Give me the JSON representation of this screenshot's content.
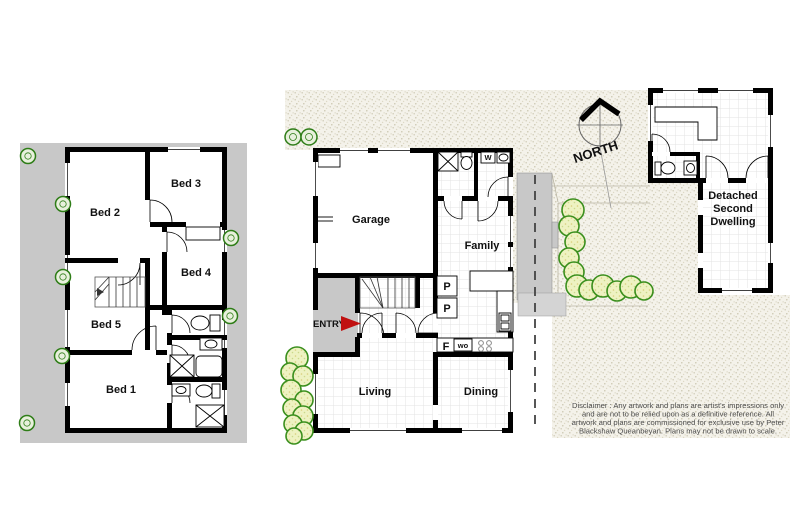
{
  "colors": {
    "wall": "#000000",
    "paving_gray": "#c8c8c8",
    "landing_gray": "#d4d4d4",
    "yard_base": "#f4f2ea",
    "grid_line": "#e3e3e3",
    "hedge_fill": "#eef2c2",
    "hedge_stroke": "#3a8f1d",
    "tree_stroke": "#2e7d17",
    "arrow_red": "#c01010",
    "disclaimer_text": "#4d4d4d"
  },
  "upper_floor": {
    "bed1": "Bed 1",
    "bed2": "Bed 2",
    "bed3": "Bed 3",
    "bed4": "Bed 4",
    "bed5": "Bed 5"
  },
  "ground_floor": {
    "garage": "Garage",
    "family": "Family",
    "living": "Living",
    "dining": "Dining",
    "entry": "ENTRY",
    "pantry1": "P",
    "pantry2": "P",
    "fridge": "F",
    "wall_oven": "wo",
    "washer": "W"
  },
  "second_dwelling": {
    "line1": "Detached",
    "line2": "Second",
    "line3": "Dwelling"
  },
  "compass": {
    "north": "NORTH"
  },
  "disclaimer": {
    "line1": "Disclaimer : Any artwork and plans are artist's impressions only",
    "line2": "and are not to be relied upon as a definitive reference. All",
    "line3": "artwork and plans are commissioned for exclusive use by Peter",
    "line4": "Blackshaw Queanbeyan. Plans may not be drawn to scale."
  }
}
